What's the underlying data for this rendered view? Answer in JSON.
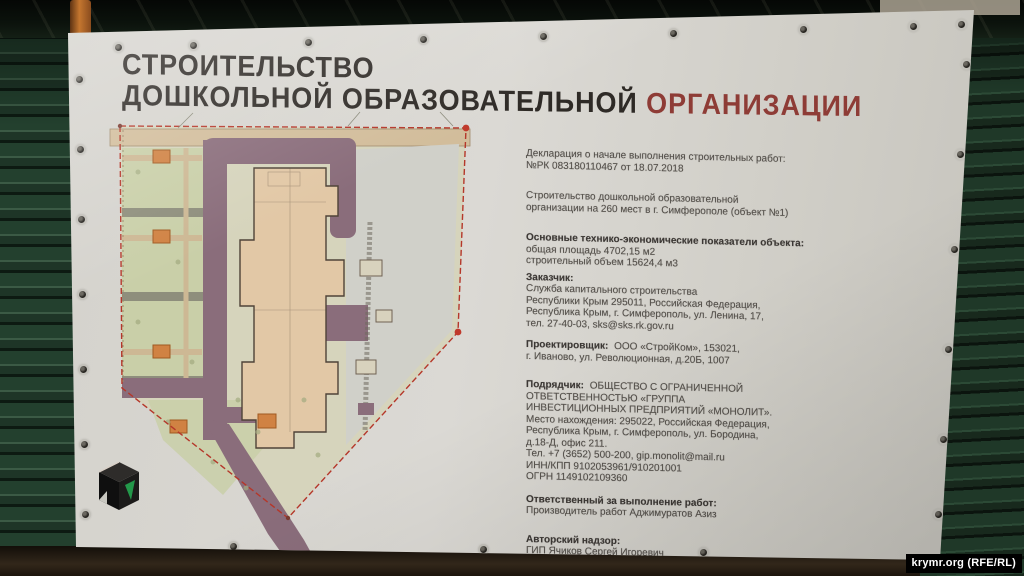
{
  "photo_credit": "krymr.org (RFE/RL)",
  "banner": {
    "title": {
      "line1": "СТРОИТЕЛЬСТВО",
      "line2_main": "ДОШКОЛЬНОЙ ОБРАЗОВАТЕЛЬНОЙ",
      "line2_accent": "ОРГАНИЗАЦИИ"
    },
    "sections": [
      {
        "header": "",
        "lines": [
          "Декларация о начале выполнения строительных работ:",
          "№РК 083180110467 от 18.07.2018"
        ]
      },
      {
        "header": "",
        "lines": [
          "Строительство дошкольной образовательной",
          "организации на 260 мест в г. Симферополе (объект №1)"
        ]
      },
      {
        "header": "Основные технико-экономические показатели объекта:",
        "lines": [
          "общая площадь 4702,15 м2",
          "строительный объем 15624,4 м3"
        ]
      },
      {
        "header": "Заказчик:",
        "lines": [
          "Служба капитального строительства",
          "Республики Крым 295011, Российская Федерация,",
          "Республика Крым, г. Симферополь, ул. Ленина, 17,",
          "тел. 27-40-03, sks@sks.rk.gov.ru"
        ]
      },
      {
        "header": "Проектировщик:",
        "lines": [
          "ООО «СтройКом», 153021,",
          "г. Иваново, ул. Революционная, д.20Б, 1007"
        ]
      },
      {
        "header": "Подрядчик:",
        "lines": [
          "ОБЩЕСТВО С ОГРАНИЧЕННОЙ",
          "ОТВЕТСТВЕННОСТЬЮ «ГРУППА",
          "ИНВЕСТИЦИОННЫХ ПРЕДПРИЯТИЙ «МОНОЛИТ».",
          "Место нахождения: 295022, Российская Федерация,",
          "Республика Крым, г. Симферополь, ул. Бородина,",
          "д.18-Д, офис 211.",
          "Тел. +7 (3652) 500-200, gip.monolit@mail.ru",
          "ИНН/КПП 9102053961/910201001",
          "ОГРН 1149102109360"
        ]
      },
      {
        "header": "Ответственный за выполнение работ:",
        "lines": [
          "Производитель работ Аджимуратов Азиз"
        ]
      },
      {
        "header": "Авторский надзор:",
        "lines": [
          "ГИП Ячиков Сергей Игоревич"
        ]
      },
      {
        "header": "Технический надзор:",
        "lines": [
          "Инженер технадзора"
        ]
      }
    ]
  },
  "site_plan": {
    "description": "Генплан участка детского сада",
    "colors": {
      "building": "#e2c8a6",
      "roads": "#8a6d7b",
      "greenery": "#c9cfa8",
      "boundary_line": "#b5372a",
      "playground_marker": "#d08243",
      "top_road": "#d2bd9b"
    }
  },
  "colors": {
    "banner_bg": "#d6d4ce",
    "fence_green": "#1c3326",
    "title_dark": "#2e2a26",
    "title_accent": "#8e3c36"
  }
}
